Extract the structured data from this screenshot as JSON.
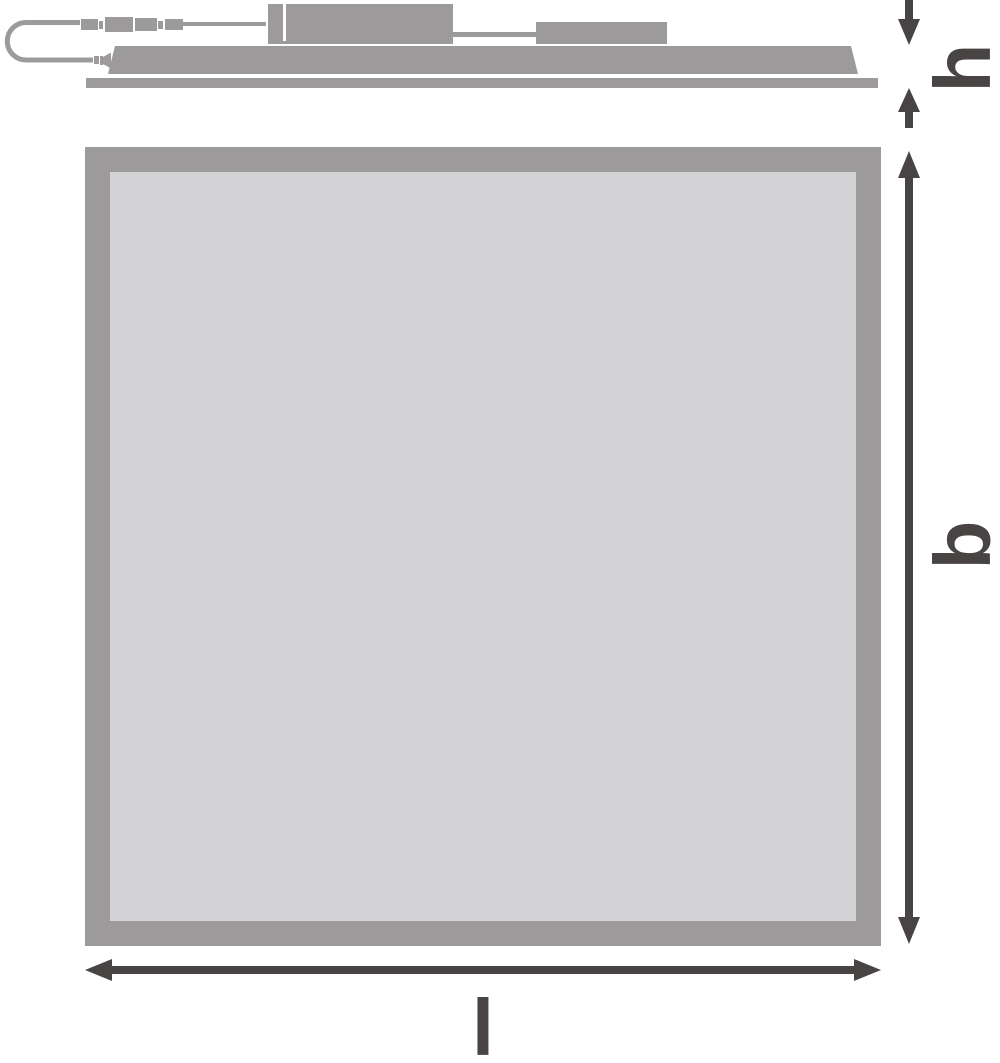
{
  "labels": {
    "height": "h",
    "width": "b",
    "length": "l"
  },
  "colors": {
    "shape_gray": "#9c9a9b",
    "panel_fill": "#d3d3d5",
    "dimension_dark": "#474443",
    "background": "#ffffff"
  }
}
